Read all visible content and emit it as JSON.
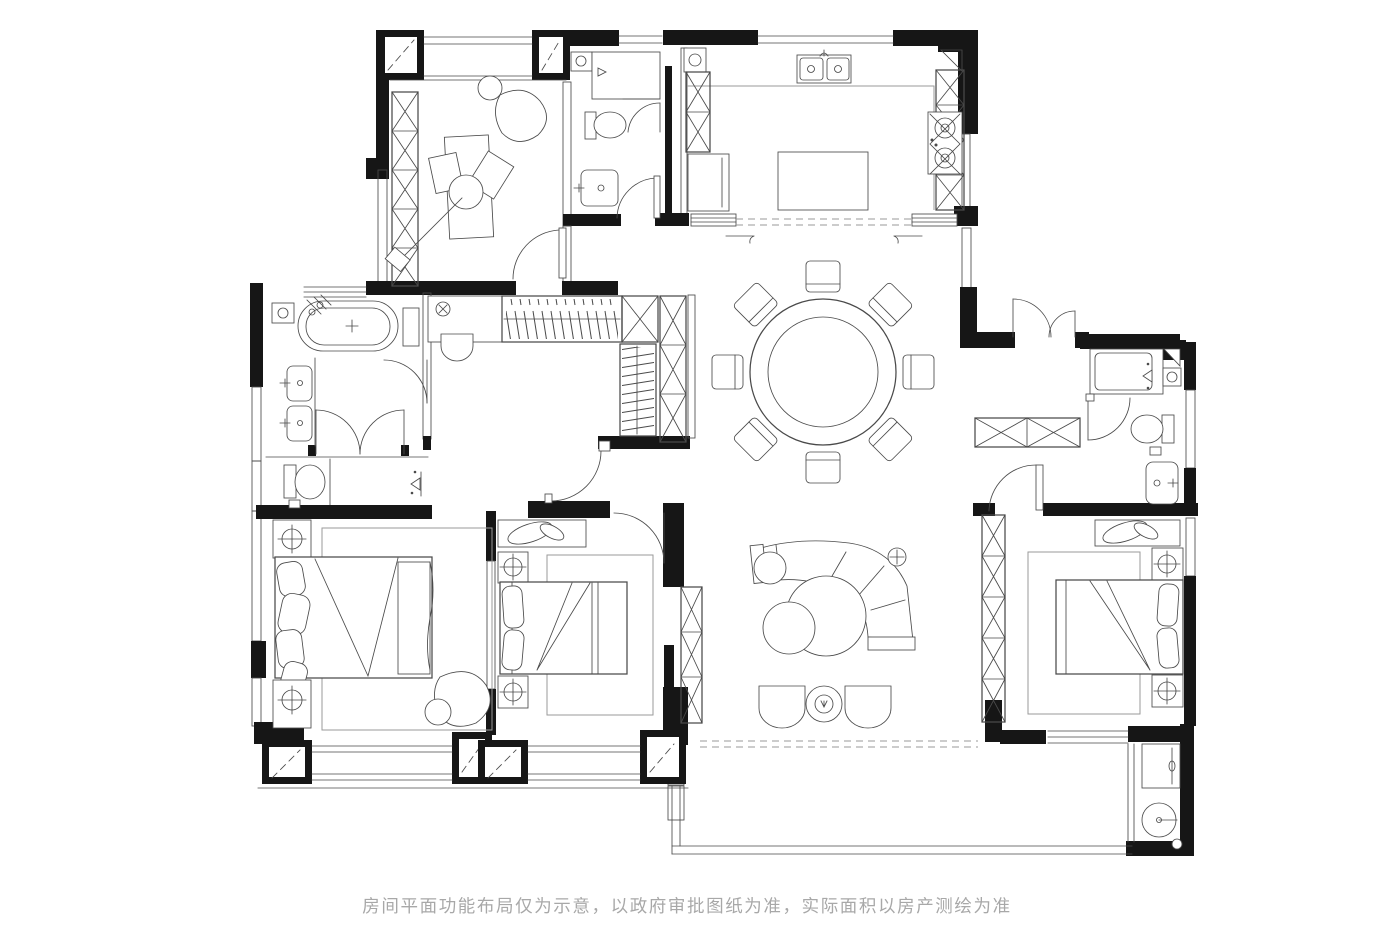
{
  "disclaimer": {
    "text": "房间平面功能布局仅为示意，以政府审批图纸为准，实际面积以房产测绘为准"
  },
  "colors": {
    "background": "#ffffff",
    "wall": "#161616",
    "ink": "#4a4a4a",
    "soft": "#9a9a9a",
    "text": "#a8a8a8"
  }
}
